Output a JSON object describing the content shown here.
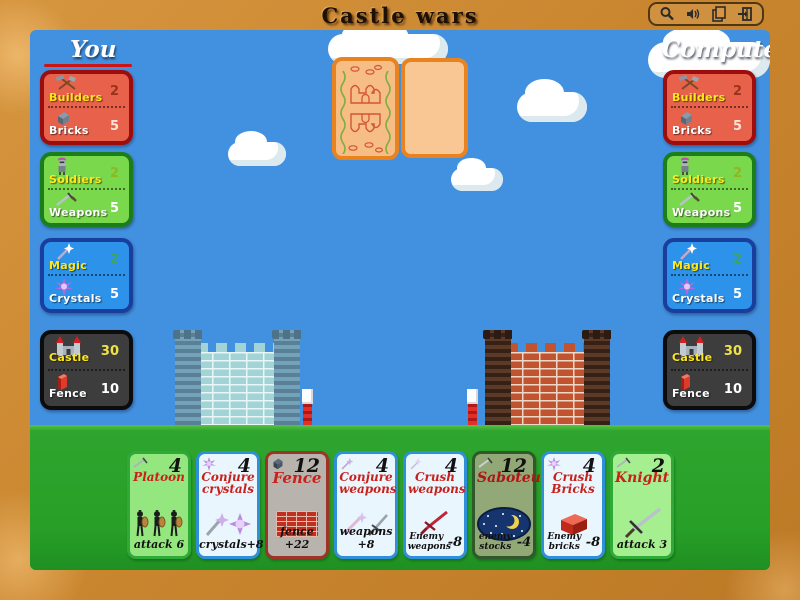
{
  "title": "Castle wars",
  "toolbar": {
    "icons": [
      "magnifier",
      "speaker",
      "pages",
      "exit-door"
    ]
  },
  "players": {
    "you": {
      "label": "You",
      "has_turn_underline": true,
      "panels": [
        {
          "top_label": "Builders",
          "top_value": "2",
          "bottom_label": "Bricks",
          "bottom_value": "5"
        },
        {
          "top_label": "Soldiers",
          "top_value": "2",
          "bottom_label": "Weapons",
          "bottom_value": "5"
        },
        {
          "top_label": "Magic",
          "top_value": "2",
          "bottom_label": "Crystals",
          "bottom_value": "5"
        },
        {
          "top_label": "Castle",
          "top_value": "30",
          "bottom_label": "Fence",
          "bottom_value": "10"
        }
      ]
    },
    "computer": {
      "label": "Computer",
      "has_turn_underline": false,
      "panels": [
        {
          "top_label": "Builders",
          "top_value": "2",
          "bottom_label": "Bricks",
          "bottom_value": "5"
        },
        {
          "top_label": "Soldiers",
          "top_value": "2",
          "bottom_label": "Weapons",
          "bottom_value": "5"
        },
        {
          "top_label": "Magic",
          "top_value": "2",
          "bottom_label": "Crystals",
          "bottom_value": "5"
        },
        {
          "top_label": "Castle",
          "top_value": "30",
          "bottom_label": "Fence",
          "bottom_value": "10"
        }
      ]
    }
  },
  "board": {
    "deck_card": "card-back-with-castle-pattern",
    "played_card": "blank-face-card",
    "left_castle": "blue-castle",
    "right_castle": "red-brick-castle"
  },
  "hand": [
    {
      "name": "Platoon",
      "cost": "4",
      "effect": "attack 6"
    },
    {
      "name": "Conjure crystals",
      "cost": "4",
      "effect": "crystals+8"
    },
    {
      "name": "Fence",
      "cost": "12",
      "effect": "fence +22"
    },
    {
      "name": "Conjure weapons",
      "cost": "4",
      "effect": "weapons +8"
    },
    {
      "name": "Crush weapons",
      "cost": "4",
      "effect": "Enemy weapons",
      "effect_value": "-8"
    },
    {
      "name": "Saboteur",
      "cost": "12",
      "effect": "enemy stocks",
      "effect_value": "-4"
    },
    {
      "name": "Crush Bricks",
      "cost": "4",
      "effect": "Enemy bricks",
      "effect_value": "-8"
    },
    {
      "name": "Knight",
      "cost": "2",
      "effect": "attack 3"
    }
  ],
  "colors": {
    "frame": "#c9852e",
    "sky": "#4291e0",
    "grass": "#28a028",
    "panel_red": "#e8614b",
    "panel_green": "#79d84b",
    "panel_blue": "#2d92e9",
    "panel_dark": "#3d3d3d",
    "card_border_orange": "#e8831f",
    "turn_underline": "#cc1414",
    "label_yellow": "#ffe818",
    "label_white": "#ffffff"
  }
}
